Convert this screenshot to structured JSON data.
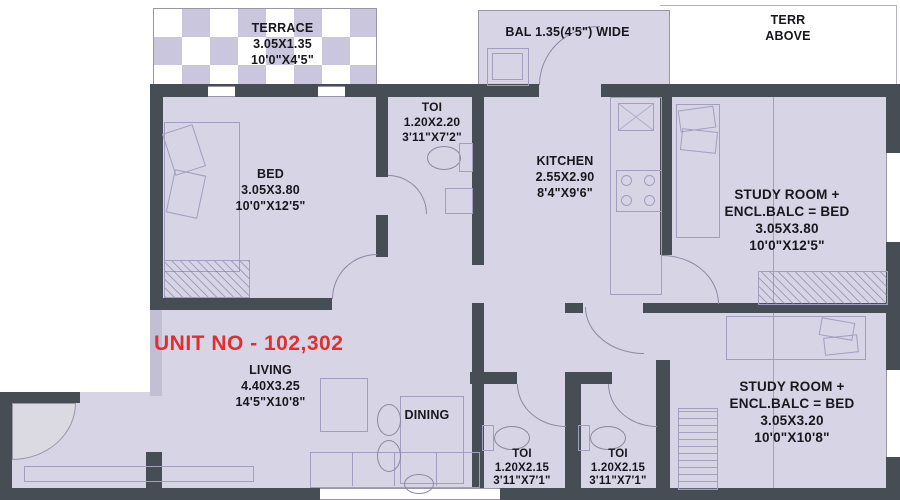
{
  "unit": {
    "label": "UNIT NO - 102,302"
  },
  "colors": {
    "wall": "#474d55",
    "room_fill": "#d7d4e6",
    "accent_red": "#e12f2f",
    "checker": "#c9c6dd"
  },
  "rooms": {
    "terrace": {
      "name": "TERRACE",
      "dim_m": "3.05X1.35",
      "dim_ft": "10'0\"X4'5\""
    },
    "balcony": {
      "name": "BAL 1.35(4'5\") WIDE"
    },
    "terr_above": {
      "line1": "TERR",
      "line2": "ABOVE"
    },
    "bed": {
      "name": "BED",
      "dim_m": "3.05X3.80",
      "dim_ft": "10'0\"X12'5\""
    },
    "toi_top": {
      "name": "TOI",
      "dim_m": "1.20X2.20",
      "dim_ft": "3'11\"X7'2\""
    },
    "kitchen": {
      "name": "KITCHEN",
      "dim_m": "2.55X2.90",
      "dim_ft": "8'4\"X9'6\""
    },
    "study_top": {
      "line1": "STUDY ROOM +",
      "line2": "ENCL.BALC = BED",
      "dim_m": "3.05X3.80",
      "dim_ft": "10'0\"X12'5\""
    },
    "living": {
      "name": "LIVING",
      "dim_m": "4.40X3.25",
      "dim_ft": "14'5\"X10'8\""
    },
    "dining": {
      "name": "DINING"
    },
    "toi_bottom_1": {
      "name": "TOI",
      "dim_m": "1.20X2.15",
      "dim_ft": "3'11\"X7'1\""
    },
    "toi_bottom_2": {
      "name": "TOI",
      "dim_m": "1.20X2.15",
      "dim_ft": "3'11\"X7'1\""
    },
    "study_bottom": {
      "line1": "STUDY ROOM +",
      "line2": "ENCL.BALC = BED",
      "dim_m": "3.05X3.20",
      "dim_ft": "10'0\"X10'8\""
    }
  }
}
